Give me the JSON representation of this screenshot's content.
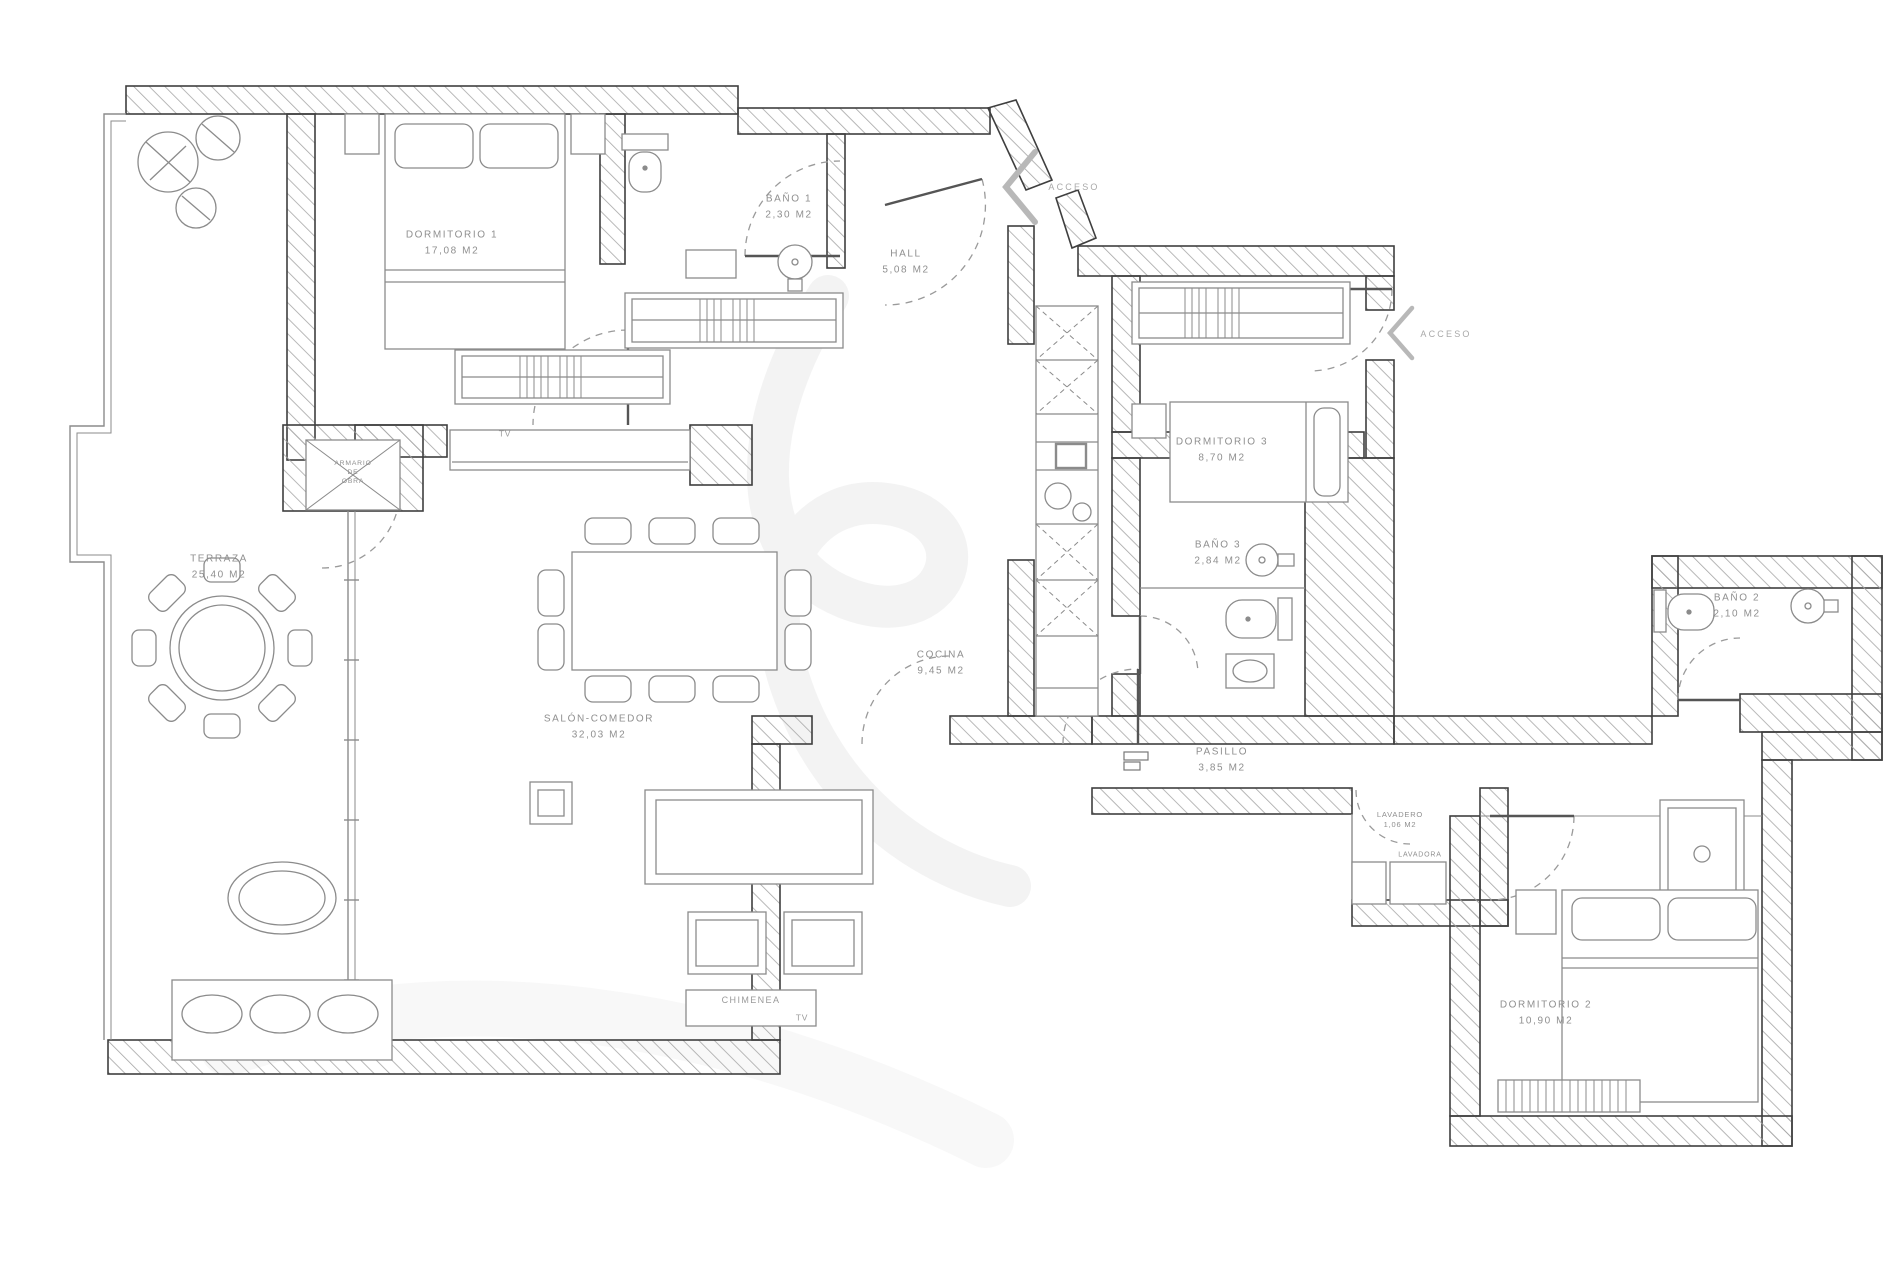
{
  "plan_type": "apartment-floor-plan",
  "labels": {
    "dormitorio1": {
      "name": "DORMITORIO 1",
      "area": "17,08 M2"
    },
    "bano1": {
      "name": "BAÑO 1",
      "area": "2,30 M2"
    },
    "hall": {
      "name": "HALL",
      "area": "5,08 M2"
    },
    "terraza": {
      "name": "TERRAZA",
      "area": "25,40 M2"
    },
    "armario": {
      "line1": "ARMARIO",
      "line2": "DE",
      "line3": "OBRA"
    },
    "dormitorio3": {
      "name": "DORMITORIO 3",
      "area": "8,70 M2"
    },
    "bano3": {
      "name": "BAÑO 3",
      "area": "2,84 M2"
    },
    "bano2": {
      "name": "BAÑO 2",
      "area": "2,10 M2"
    },
    "cocina": {
      "name": "COCINA",
      "area": "9,45 M2"
    },
    "salon": {
      "name": "SALÓN-COMEDOR",
      "area": "32,03 M2"
    },
    "pasillo": {
      "name": "PASILLO",
      "area": "3,85 M2"
    },
    "lavadero": {
      "name": "LAVADERO",
      "area": "1,06 M2"
    },
    "lavadora": {
      "name": "LAVADORA"
    },
    "dormitorio2": {
      "name": "DORMITORIO 2",
      "area": "10,90 M2"
    },
    "chimenea": {
      "name": "CHIMENEA"
    },
    "tv_salon": {
      "name": "TV"
    },
    "tv_chimenea": {
      "name": "TV"
    },
    "acceso1": {
      "name": "ACCESO"
    },
    "acceso2": {
      "name": "ACCESO"
    }
  },
  "colors": {
    "wall_stroke": "#3f3f3f",
    "hatch_line": "#a6a6a6",
    "furniture_line": "#8b8b8b",
    "label_text": "#8f8f8f",
    "door_arc": "#9a9a9a",
    "watermark": "#d6d6d6",
    "background": "#ffffff"
  }
}
